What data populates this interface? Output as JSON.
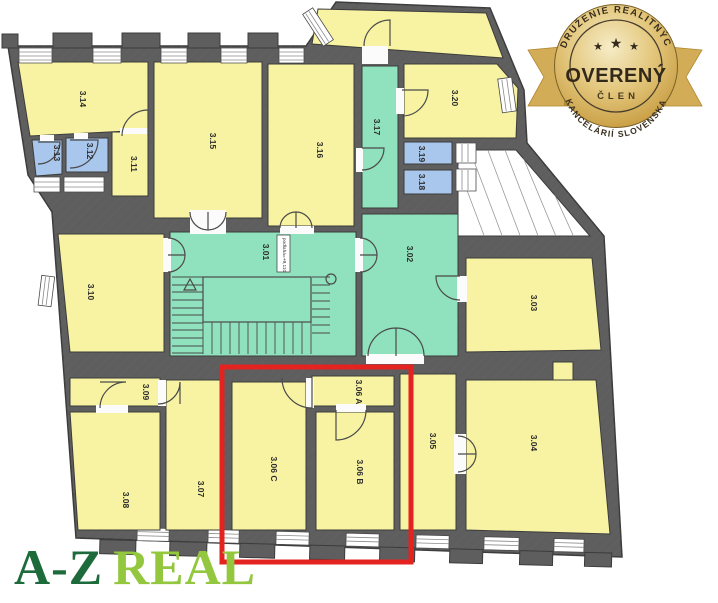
{
  "image": {
    "width": 718,
    "height": 603,
    "background": "#ffffff"
  },
  "floorplan": {
    "colors": {
      "wall": "#5e5e5e",
      "room_yellow": "#f7f3a2",
      "room_green": "#8fe2bd",
      "room_blue": "#a9c7ec",
      "courtyard_white": "#ffffff",
      "outline": "#3c3c3c",
      "highlight_red": "#e42320"
    },
    "rooms": [
      {
        "id": "3.01",
        "label": "3.01"
      },
      {
        "id": "3.02",
        "label": "3.02"
      },
      {
        "id": "3.03",
        "label": "3.03"
      },
      {
        "id": "3.04",
        "label": "3.04"
      },
      {
        "id": "3.05",
        "label": "3.05"
      },
      {
        "id": "3.06 A",
        "label": "3.06 A"
      },
      {
        "id": "3.06 B",
        "label": "3.06 B"
      },
      {
        "id": "3.06 C",
        "label": "3.06 C"
      },
      {
        "id": "3.07",
        "label": "3.07"
      },
      {
        "id": "3.08",
        "label": "3.08"
      },
      {
        "id": "3.09",
        "label": "3.09"
      },
      {
        "id": "3.10",
        "label": "3.10"
      },
      {
        "id": "3.11",
        "label": "3.11"
      },
      {
        "id": "3.12",
        "label": "3.12"
      },
      {
        "id": "3.13",
        "label": "3.13"
      },
      {
        "id": "3.14",
        "label": "3.14"
      },
      {
        "id": "3.15",
        "label": "3.15"
      },
      {
        "id": "3.16",
        "label": "3.16"
      },
      {
        "id": "3.17",
        "label": "3.17"
      },
      {
        "id": "3.18",
        "label": "3.18"
      },
      {
        "id": "3.19",
        "label": "3.19"
      },
      {
        "id": "3.20",
        "label": "3.20"
      }
    ],
    "elevation_label": "podlaha=+9,110",
    "highlighted_rooms": [
      "3.06 A",
      "3.06 B",
      "3.06 C"
    ]
  },
  "badge": {
    "arc_top": "ZDRUŽENIE REALITNÝCH",
    "title": "OVERENÝ",
    "subtitle": "ČLEN",
    "arc_bottom": "KANCELÁRIÍ SLOVENSKA",
    "star": "★",
    "colors": {
      "gold_light": "#f6ecc6",
      "gold": "#d4b166",
      "gold_dark": "#b3872f",
      "ribbon": "#d3ac57",
      "text": "#33291a"
    }
  },
  "logo": {
    "part1": "A-Z",
    "part2": "REAL",
    "color1": "#1d6b3b",
    "color2": "#93c73e"
  }
}
